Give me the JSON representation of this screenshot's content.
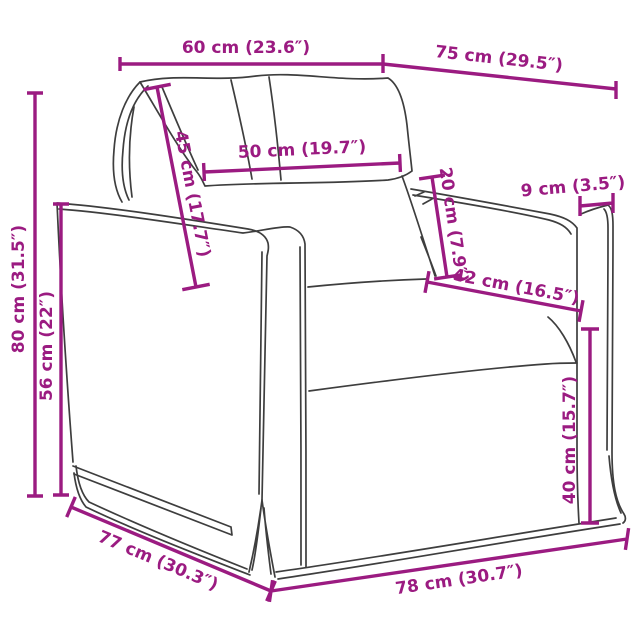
{
  "diagram": {
    "type": "product-dimension-diagram",
    "product": "armchair-line-drawing",
    "colors": {
      "dimension": "#9b1b81",
      "line": "#3e3e3e",
      "background": "#ffffff"
    },
    "dimensions": {
      "back_width": "60 cm (23.6″)",
      "top_depth": "75 cm (29.5″)",
      "backrest_height": "45 cm (17.7″)",
      "back_cushion_width": "50 cm (19.7″)",
      "cushion_height": "20 cm (7.9″)",
      "armrest_width": "9 cm (3.5″)",
      "seat_depth": "42 cm (16.5″)",
      "seat_height": "40 cm (15.7″)",
      "total_height": "80 cm (31.5″)",
      "armrest_height": "56 cm (22″)",
      "base_depth": "77 cm (30.3″)",
      "base_width": "78 cm (30.7″)"
    }
  }
}
